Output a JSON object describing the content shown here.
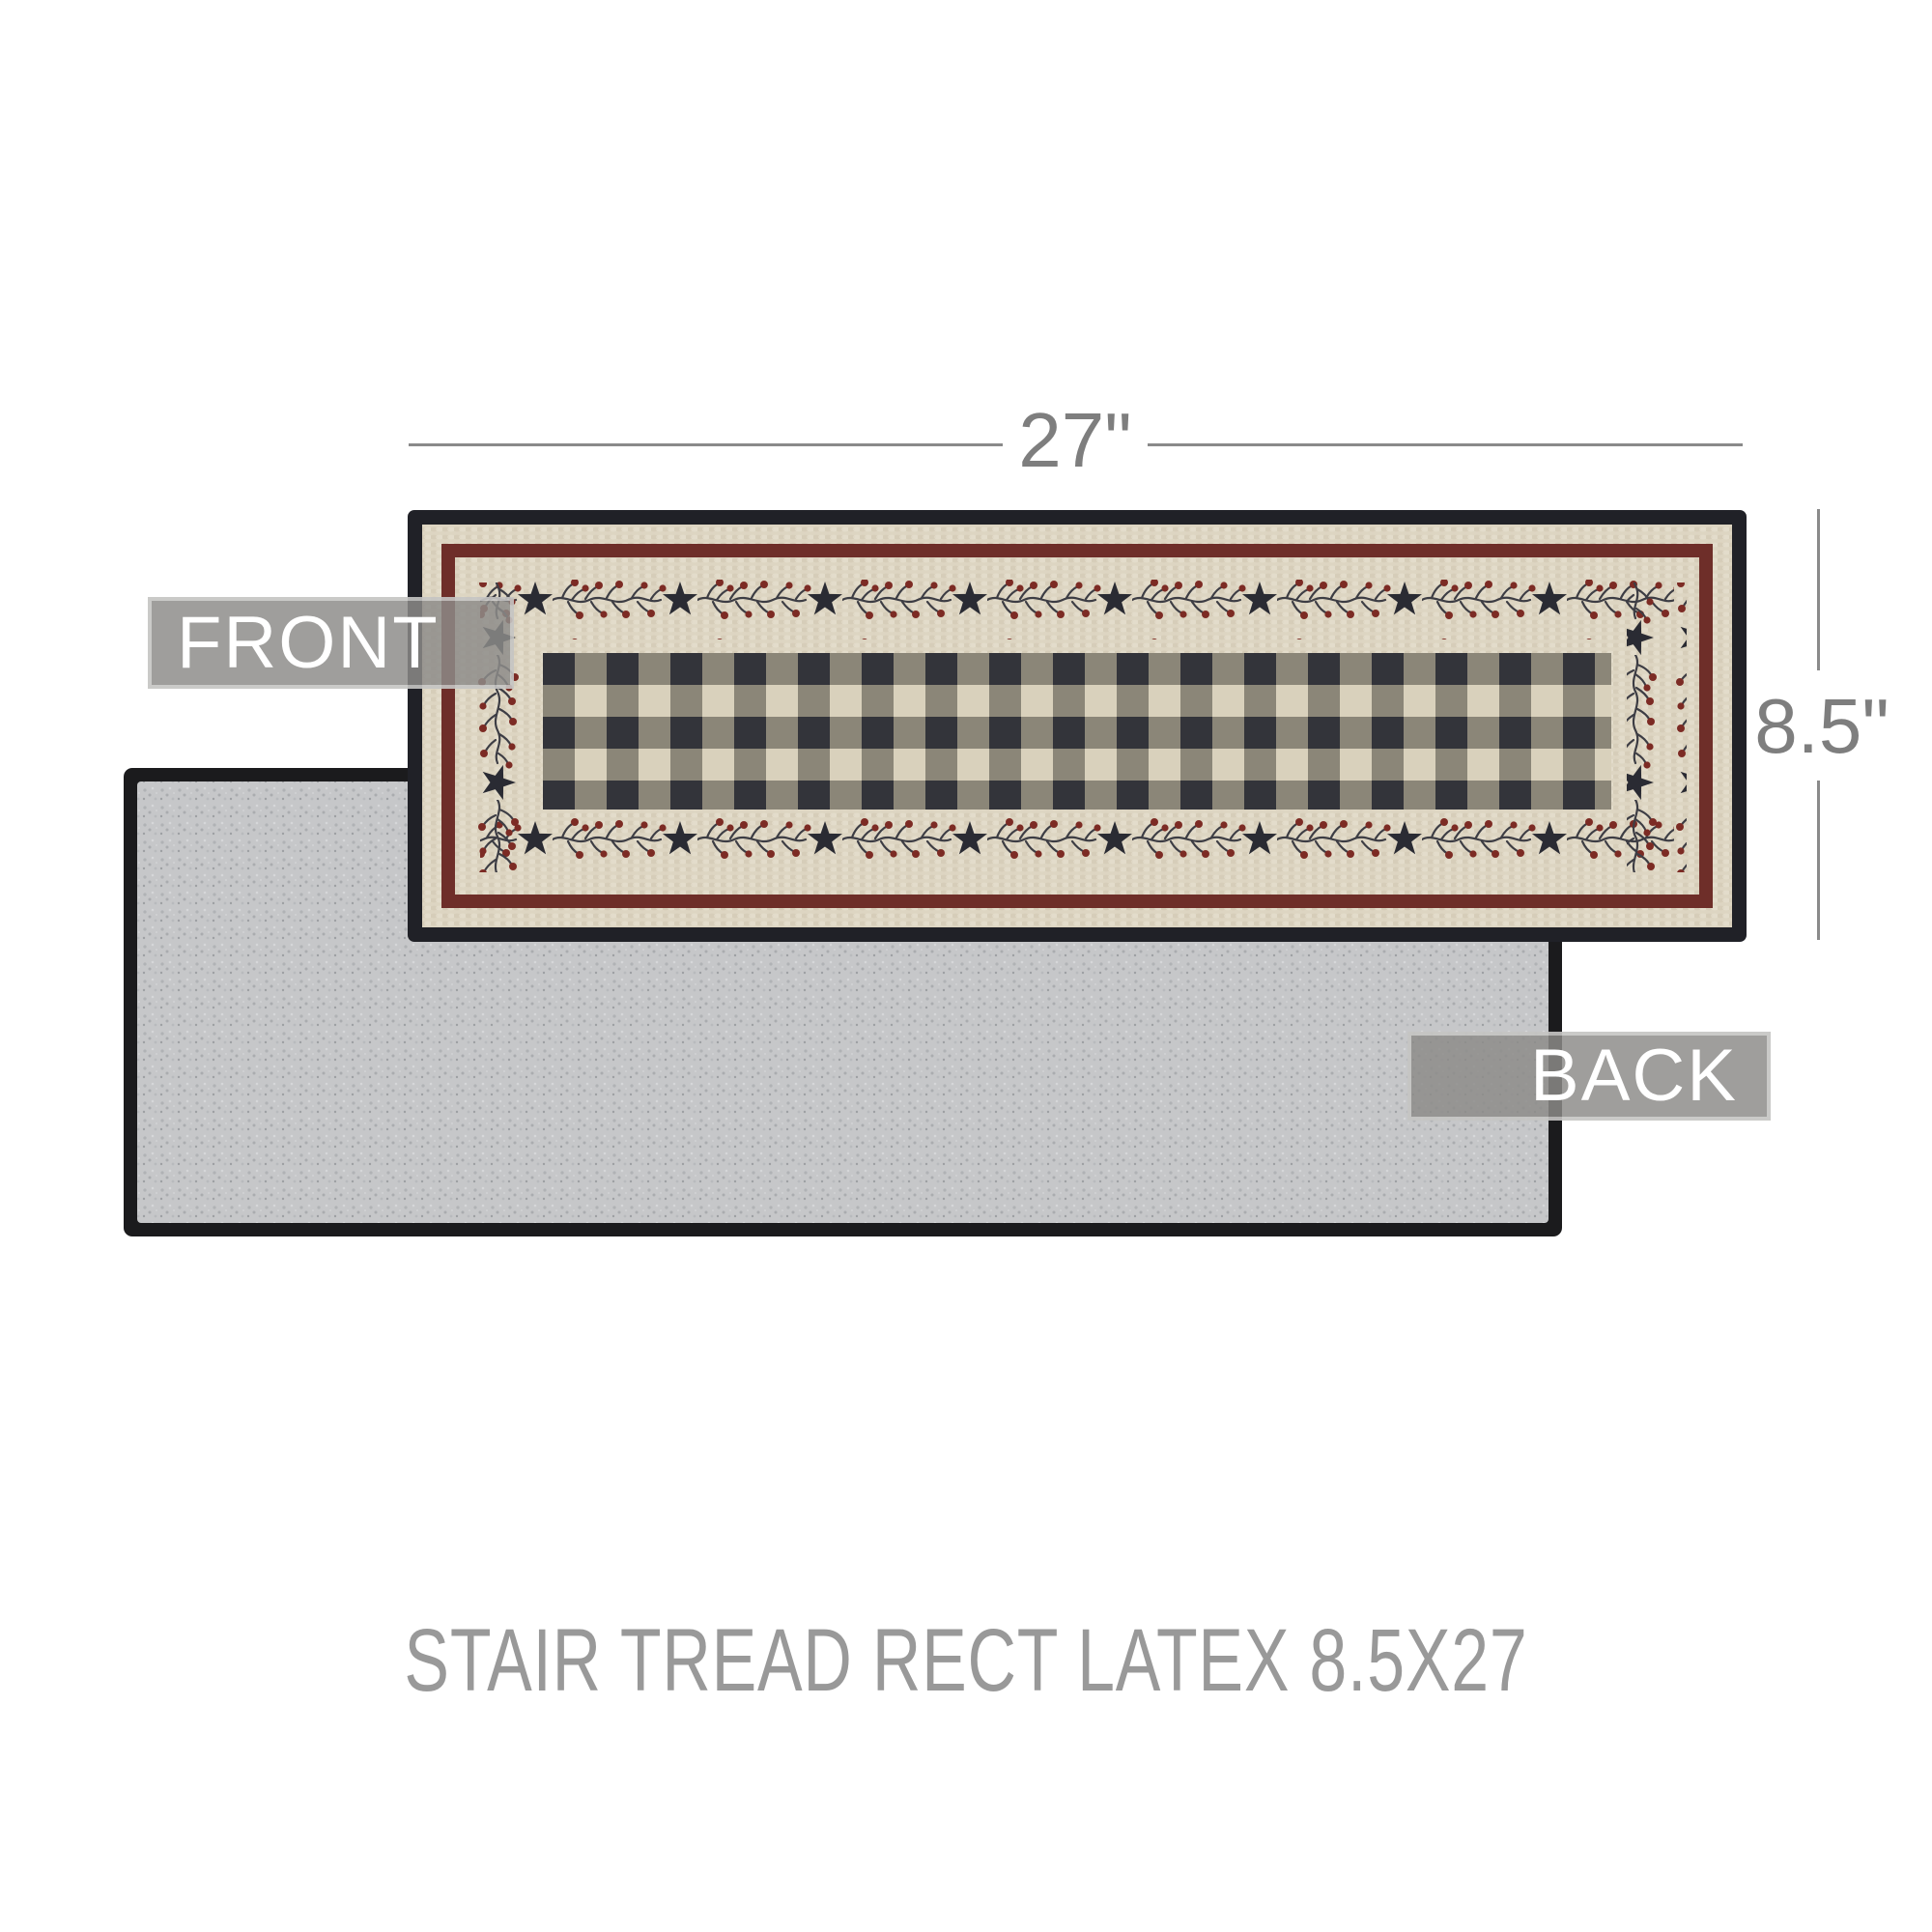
{
  "annotations": {
    "width_dimension": "27\"",
    "height_dimension": "8.5\"",
    "front_view_label": "FRONT",
    "back_view_label": "BACK",
    "caption": "STAIR TREAD RECT LATEX 8.5X27"
  },
  "colors": {
    "background": "#ffffff",
    "dimension_line": "#8a8a8a",
    "dimension_text": "#7e7e7e",
    "caption_text": "#999999",
    "label_text": "#ffffff",
    "label_overlay": "rgba(141,139,137,0.84)",
    "rug_binding_black": "#202127",
    "rug_beige": "#ddd5c2",
    "rug_braid_shade": "#d0c6af",
    "rug_braid_light": "#eae3d4",
    "rug_maroon": "#6e2e29",
    "check_dark": "#33343a",
    "check_mixed": "#8b8678",
    "check_light": "#d9d1bc",
    "star_navy": "#2a2b33",
    "berry_red": "#7c2b24",
    "vine_stem": "#3d3d44",
    "back_fabric_gray": "#c6c7c9",
    "back_binding_black": "#1b1b1d"
  }
}
